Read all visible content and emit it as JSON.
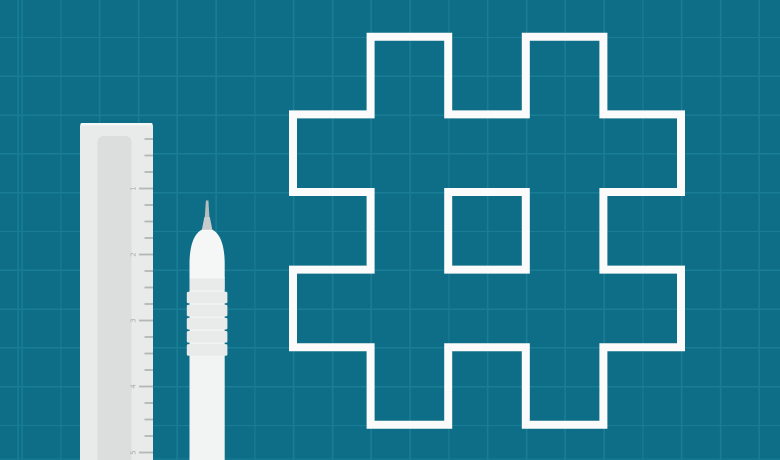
{
  "scene": {
    "alt": "Flat blueprint-style illustration: white outlined hashtag symbol on teal grid paper beside a vertical ruler and a technical drawing pen",
    "background_color": "#0f6e87",
    "grid_line_color": "#197d95"
  },
  "hashtag": {
    "symbol": "#",
    "stroke_color": "#fbfbfb"
  },
  "ruler": {
    "numbers": [
      "1",
      "2",
      "3",
      "4",
      "5"
    ],
    "body_color": "#e9eaea",
    "highlight_color": "#f6f7f7",
    "slot_color": "#dcdddd",
    "tick_color": "#b4b7b8",
    "number_color": "#a7abad"
  },
  "pen": {
    "needle_color": "#b8bdbf",
    "cone_color": "#c7cbcc",
    "nib_color": "#f5f6f6",
    "barrel_color": "#f2f3f3",
    "grip_band_color": "#e9ebeb"
  }
}
